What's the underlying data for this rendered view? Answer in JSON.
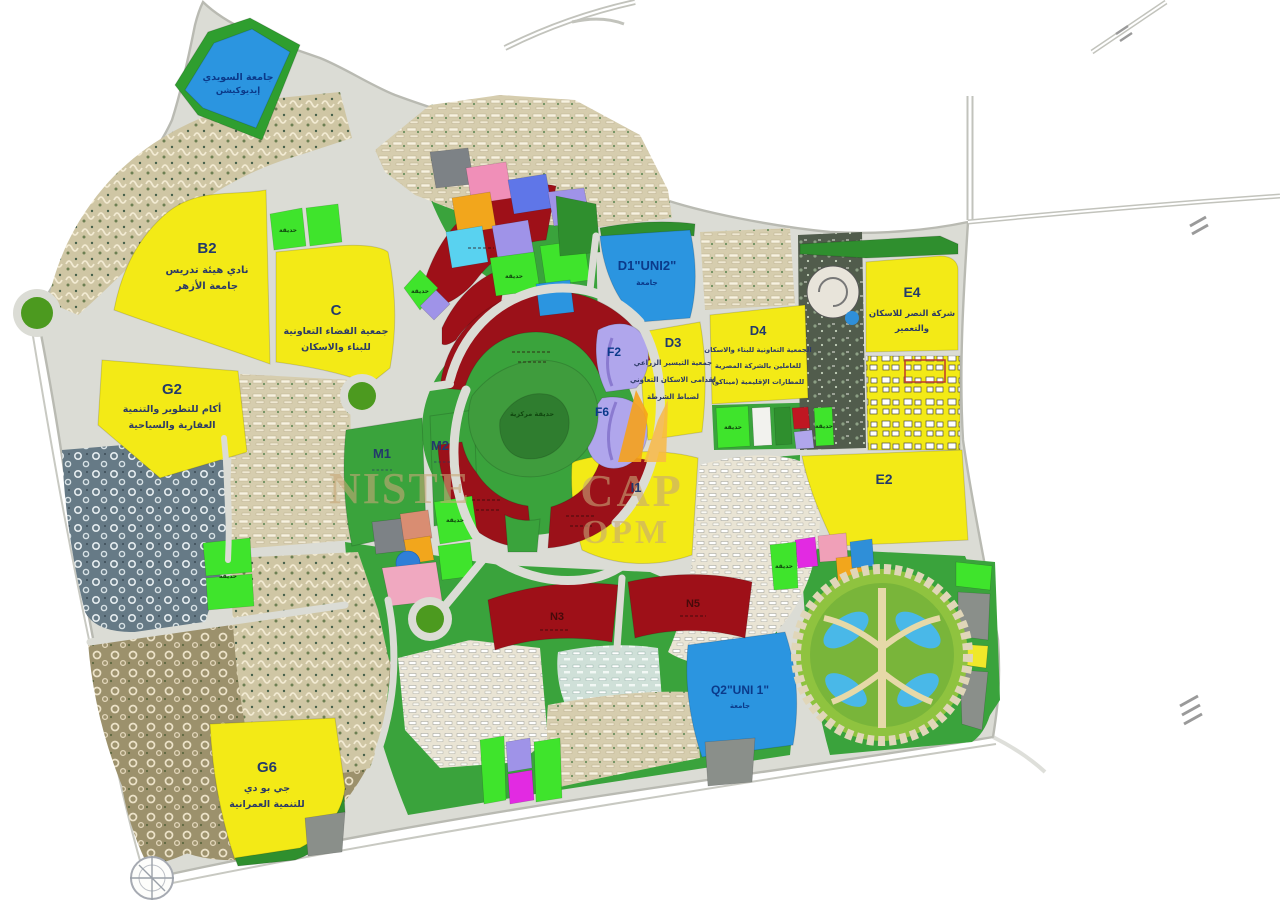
{
  "districts": [
    {
      "id": "univ",
      "label": "جامعة السويدي",
      "sub": [
        "إيديوكيشن"
      ]
    },
    {
      "id": "b2",
      "label": "B2",
      "sub": [
        "نادي هيئة تدريس",
        "جامعة الأزهر"
      ]
    },
    {
      "id": "c",
      "label": "C",
      "sub": [
        "جمعية الفضاء التعاونية",
        "للبناء والاسكان"
      ]
    },
    {
      "id": "g2",
      "label": "G2",
      "sub": [
        "أكام للتطوير والتنمية",
        "العقارية والسياحية"
      ]
    },
    {
      "id": "d1",
      "label": "D1\"UNI2\"",
      "sub": [
        "جامعة"
      ]
    },
    {
      "id": "d3",
      "label": "D3",
      "sub": [
        "جمعية التيسير الزراعي",
        "لقدامى الاسكان التعاوني",
        "لضباط الشرطة"
      ]
    },
    {
      "id": "d4",
      "label": "D4",
      "sub": [
        "الجمعية التعاونية للبناء والاسكان",
        "للعاملين بالشركة المصرية",
        "للمطارات الإقليمية (ميناكو)"
      ]
    },
    {
      "id": "e4",
      "label": "E4",
      "sub": [
        "شركة النصر للاسكان",
        "والتعمير"
      ]
    },
    {
      "id": "e2",
      "label": "E2",
      "sub": []
    },
    {
      "id": "i1",
      "label": "I1",
      "sub": []
    },
    {
      "id": "m1",
      "label": "M1",
      "sub": []
    },
    {
      "id": "m2",
      "label": "M2",
      "sub": []
    },
    {
      "id": "f2",
      "label": "F2",
      "sub": []
    },
    {
      "id": "f6",
      "label": "F6",
      "sub": []
    },
    {
      "id": "q2",
      "label": "Q2\"UNI 1\"",
      "sub": [
        "جامعة"
      ]
    },
    {
      "id": "g6",
      "label": "G6",
      "sub": [
        "جي بو دي",
        "للتنمية العمرانية"
      ]
    },
    {
      "id": "n3",
      "label": "N3",
      "sub": []
    },
    {
      "id": "n5",
      "label": "N5",
      "sub": []
    },
    {
      "id": "central-park",
      "label": "حديقة مركزية",
      "sub": []
    }
  ],
  "gardens": {
    "label": "حديقة"
  },
  "watermark": {
    "fragments": [
      "NISTE",
      "CAP",
      "OPM"
    ],
    "logo_color": "#f6a21c"
  },
  "colors": {
    "yellow": "#f3ea16",
    "blue": "#2b95e0",
    "dark_red": "#9e1018",
    "green": "#3aa33c",
    "bright_green": "#3fe42c",
    "purple": "#b0a6ec",
    "road": "#dbdcd5",
    "dark_green": "#2f8f2e"
  }
}
